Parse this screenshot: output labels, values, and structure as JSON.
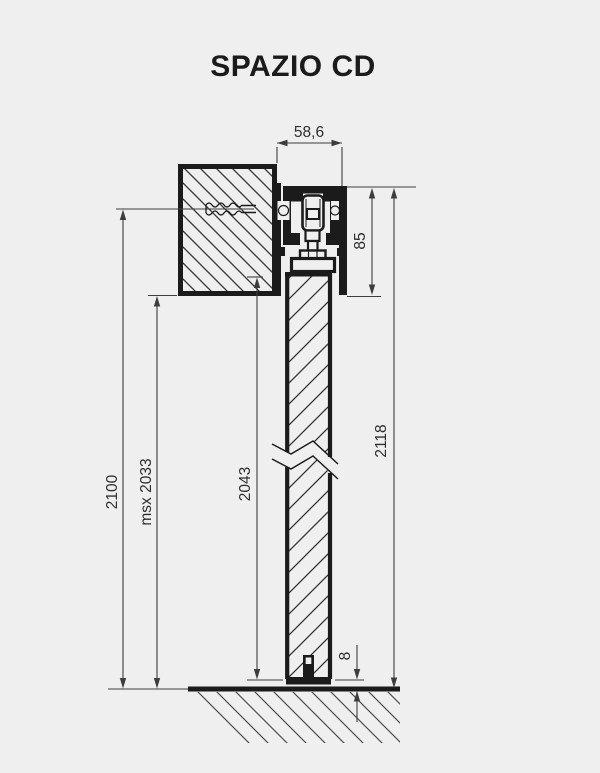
{
  "title": "SPAZIO CD",
  "colors": {
    "background": "#efefef",
    "ink": "#1b1b1b",
    "dim": "#3d3d3d",
    "hatch": "#323232",
    "ground": "#4e4e4e"
  },
  "dims": {
    "track_width": "58,6",
    "mech_height": "85",
    "total_height": "2118",
    "door_height": "2043",
    "max_clear": "msx 2033",
    "opening_height": "2100",
    "floor_gap": "8"
  }
}
